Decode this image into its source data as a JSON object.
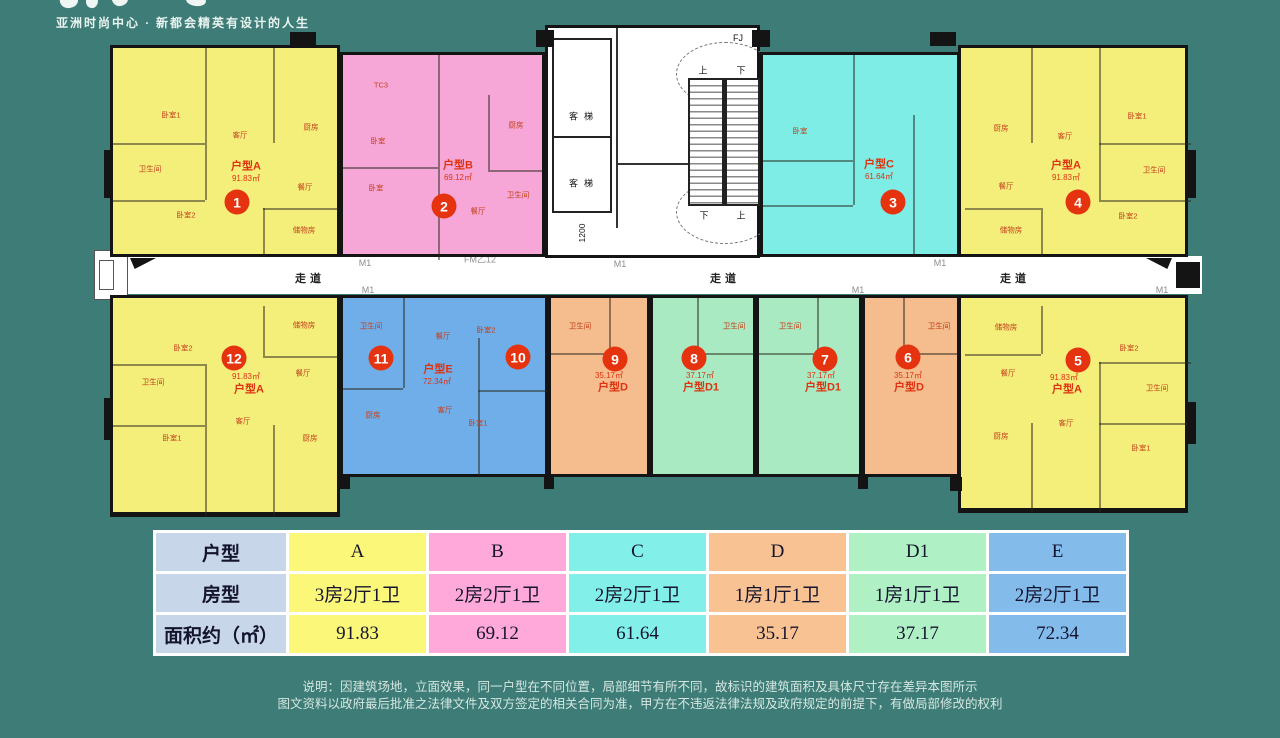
{
  "brand": {
    "tagline": "亚洲时尚中心 · 新都会精英有设计的人生"
  },
  "plan": {
    "corridor_label": "走道",
    "door_label": "M1",
    "fire_door_label": "FM乙12",
    "dim_label": "1200",
    "core": {
      "elevator": "客梯",
      "up": "上",
      "down": "下",
      "fj": "FJ"
    },
    "rooms": {
      "bedroom1": "卧室1",
      "bedroom2": "卧室2",
      "bedroom": "卧室",
      "bath": "卫生间",
      "living": "客厅",
      "kitchen": "厨房",
      "dining": "餐厅",
      "storage": "储物房",
      "tc3": "TC3"
    },
    "units": [
      {
        "no": "1",
        "type": "户型A",
        "area": "91.83㎡"
      },
      {
        "no": "2",
        "type": "户型B",
        "area": "69.12㎡"
      },
      {
        "no": "3",
        "type": "户型C",
        "area": "61.64㎡"
      },
      {
        "no": "4",
        "type": "户型A",
        "area": "91.83㎡"
      },
      {
        "no": "5",
        "type": "户型A",
        "area": "91.83㎡"
      },
      {
        "no": "6",
        "type": "户型D",
        "area": "35.17㎡"
      },
      {
        "no": "7",
        "type": "户型D1",
        "area": "37.17㎡"
      },
      {
        "no": "8",
        "type": "户型D1",
        "area": "37.17㎡"
      },
      {
        "no": "9",
        "type": "户型D",
        "area": "35.17㎡"
      },
      {
        "no": "10",
        "type": "户型E",
        "area": "72.34㎡"
      },
      {
        "no": "11",
        "type": "户型E",
        "area": "72.34㎡"
      },
      {
        "no": "12",
        "type": "户型A",
        "area": "91.83㎡"
      }
    ]
  },
  "table": {
    "row_headers": [
      "户型",
      "房型",
      "面积约（㎡）"
    ],
    "columns": [
      {
        "label": "A",
        "layout": "3房2厅1卫",
        "area": "91.83",
        "color": "#FBF879"
      },
      {
        "label": "B",
        "layout": "2房2厅1卫",
        "area": "69.12",
        "color": "#FFA9DA"
      },
      {
        "label": "C",
        "layout": "2房2厅1卫",
        "area": "61.64",
        "color": "#82F0E8"
      },
      {
        "label": "D",
        "layout": "1房1厅1卫",
        "area": "35.17",
        "color": "#F8C292"
      },
      {
        "label": "D1",
        "layout": "1房1厅1卫",
        "area": "37.17",
        "color": "#AFF0C5"
      },
      {
        "label": "E",
        "layout": "2房2厅1卫",
        "area": "72.34",
        "color": "#83BBEB"
      }
    ]
  },
  "disclaimer": {
    "line1": "说明：因建筑场地，立面效果，同一户型在不同位置，局部细节有所不同，故标识的建筑面积及具体尺寸存在差异本图所示",
    "line2": "图文资料以政府最后批准之法律文件及双方签定的相关合同为准，甲方在不违返法律法规及政府规定的前提下，有做局部修改的权利"
  },
  "colors": {
    "background": "#3D7C77",
    "unit_A": "#F4EF7B",
    "unit_B": "#F6A7D7",
    "unit_C": "#7DEDE5",
    "unit_D": "#F5BD8E",
    "unit_D1": "#A9EAC3",
    "unit_E": "#6FAEE9",
    "marker": "#E6330F",
    "header_cell": "#C7D7E9"
  }
}
